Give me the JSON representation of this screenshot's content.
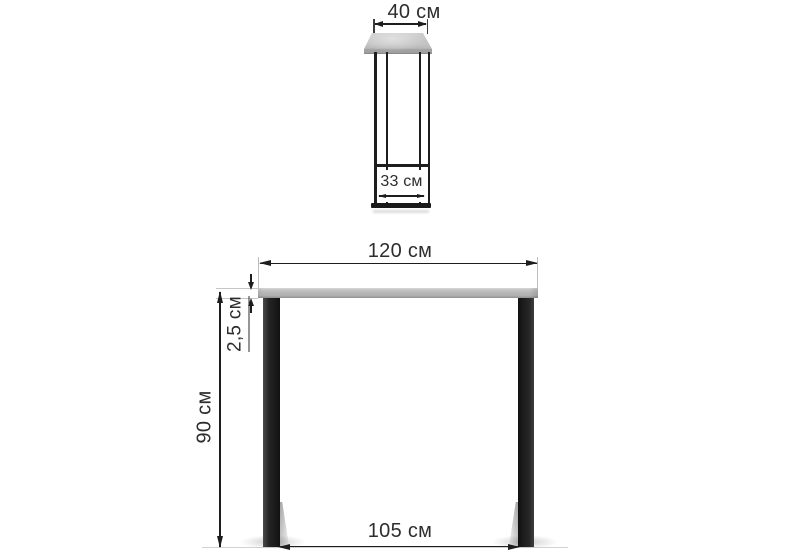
{
  "diagram": {
    "type": "furniture-dimension-drawing",
    "views": [
      "side-depth-view",
      "front-view"
    ],
    "side_view": {
      "top_width_label": "40 см",
      "inner_width_label": "33 см"
    },
    "front_view": {
      "width_label": "120 см",
      "thickness_label": "2,5 см",
      "height_label": "90 см",
      "base_span_label": "105 см"
    },
    "dimensions_cm": {
      "depth": 40,
      "base_depth_inner": 33,
      "width": 120,
      "top_thickness": 2.5,
      "height": 90,
      "base_width": 105
    },
    "colors": {
      "background": "#ffffff",
      "dimension_line": "#1d1d1d",
      "text": "#2d2d2d",
      "tabletop_gray": "#bcbcbc",
      "leg_black": "#1d1d1d",
      "extension_line": "#bdbdbd"
    }
  }
}
